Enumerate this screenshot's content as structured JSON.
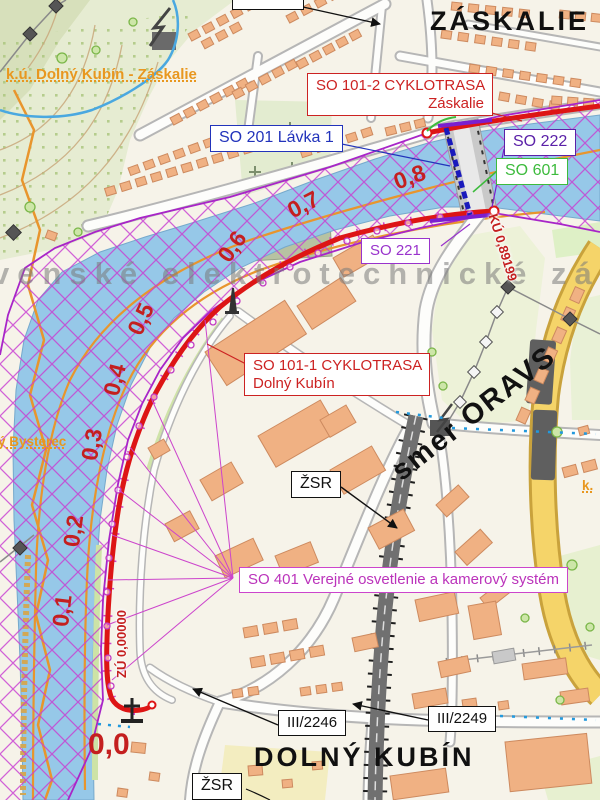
{
  "map": {
    "type": "cycling-route-planning-map",
    "place_labels": {
      "top_right": "ZÁSKALIE",
      "bottom": "DOLNÝ KUBÍN"
    },
    "cadastral_labels": {
      "top_left": "k.ú. Dolný Kubín - Záskalie",
      "mid_left": "ý Bysterec",
      "right": "k."
    },
    "watermark_text": "venské elektrotechnické závod",
    "direction_label": "smer ORAVS",
    "callouts": [
      {
        "id": "so101_2",
        "lines": [
          "SO 101-2 CYKLOTRASA",
          "Záskalie"
        ],
        "color": "#cc2222"
      },
      {
        "id": "so201",
        "lines": [
          "SO 201 Lávka 1"
        ],
        "color": "#2233bb"
      },
      {
        "id": "so222",
        "lines": [
          "SO 222"
        ],
        "color": "#5b21a8"
      },
      {
        "id": "so601",
        "lines": [
          "SO 601"
        ],
        "color": "#3dbb3d"
      },
      {
        "id": "so221",
        "lines": [
          "SO 221"
        ],
        "color": "#9933cc"
      },
      {
        "id": "so101_1",
        "lines": [
          "SO 101-1 CYKLOTRASA",
          "Dolný Kubín"
        ],
        "color": "#cc2222"
      },
      {
        "id": "zsr_1",
        "lines": [
          "ŽSR"
        ],
        "color": "#111111"
      },
      {
        "id": "so401",
        "lines": [
          "SO 401 Verejné osvetlenie a kamerový systém"
        ],
        "color": "#bb33bb"
      },
      {
        "id": "road2246",
        "lines": [
          "III/2246"
        ],
        "color": "#111111"
      },
      {
        "id": "road2249",
        "lines": [
          "III/2249"
        ],
        "color": "#111111"
      },
      {
        "id": "zsr_2",
        "lines": [
          "ŽSR"
        ],
        "color": "#111111"
      }
    ],
    "chainage": {
      "start_label": "ZÚ 0,00000",
      "end_label": "KÚ 0,89199",
      "markers": [
        "0,0",
        "0,1",
        "0,2",
        "0,3",
        "0,4",
        "0,5",
        "0,6",
        "0,7",
        "0,8"
      ]
    },
    "colors": {
      "route_red": "#dd1515",
      "flood_hatch_magenta": "#c83cd2",
      "river_blue": "#96c8e8",
      "buildings_salmon": "#f0b183",
      "yellow_road": "#f5d469",
      "cadastral_orange": "#e8971f",
      "railway_gray": "#707070"
    }
  }
}
